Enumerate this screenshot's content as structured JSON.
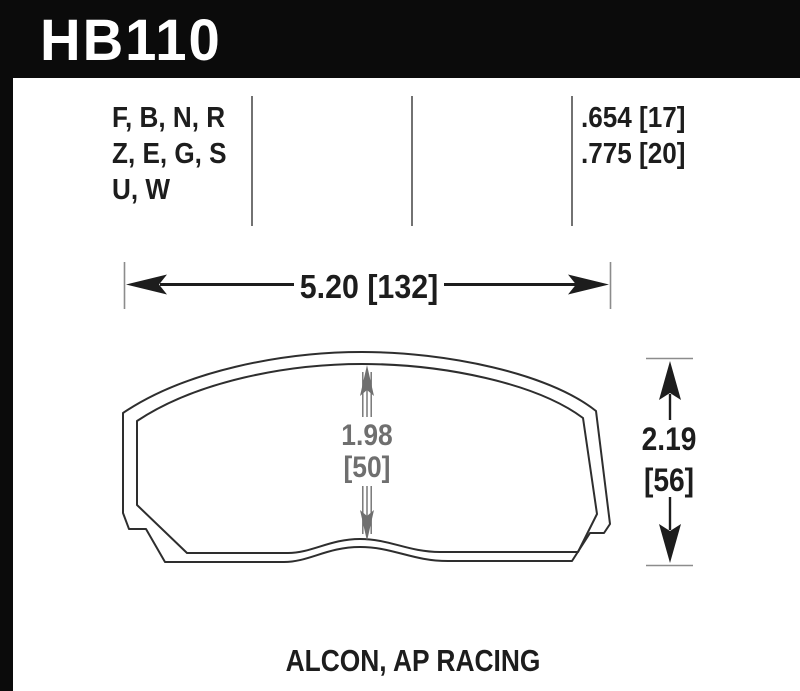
{
  "part": {
    "number": "HB110"
  },
  "spec_table": {
    "compound_codes": [
      "F, B, N, R",
      "Z, E, G, S",
      "U, W"
    ],
    "pad_thickness": [
      ".654 [17]",
      ".775 [20]"
    ]
  },
  "dimensions": {
    "width": "5.20 [132]",
    "friction_height_in": "1.98",
    "friction_height_mm": "[50]",
    "overall_height_in": "2.19",
    "overall_height_mm": "[56]"
  },
  "footer": {
    "applications": "ALCON, AP RACING"
  },
  "colors": {
    "header_bg": "#0b0b0b",
    "ink": "#1d1d1d",
    "dim_gray": "#6f6f6f",
    "tick_gray": "#8c8c8c",
    "outline": "#2e2e2e"
  }
}
